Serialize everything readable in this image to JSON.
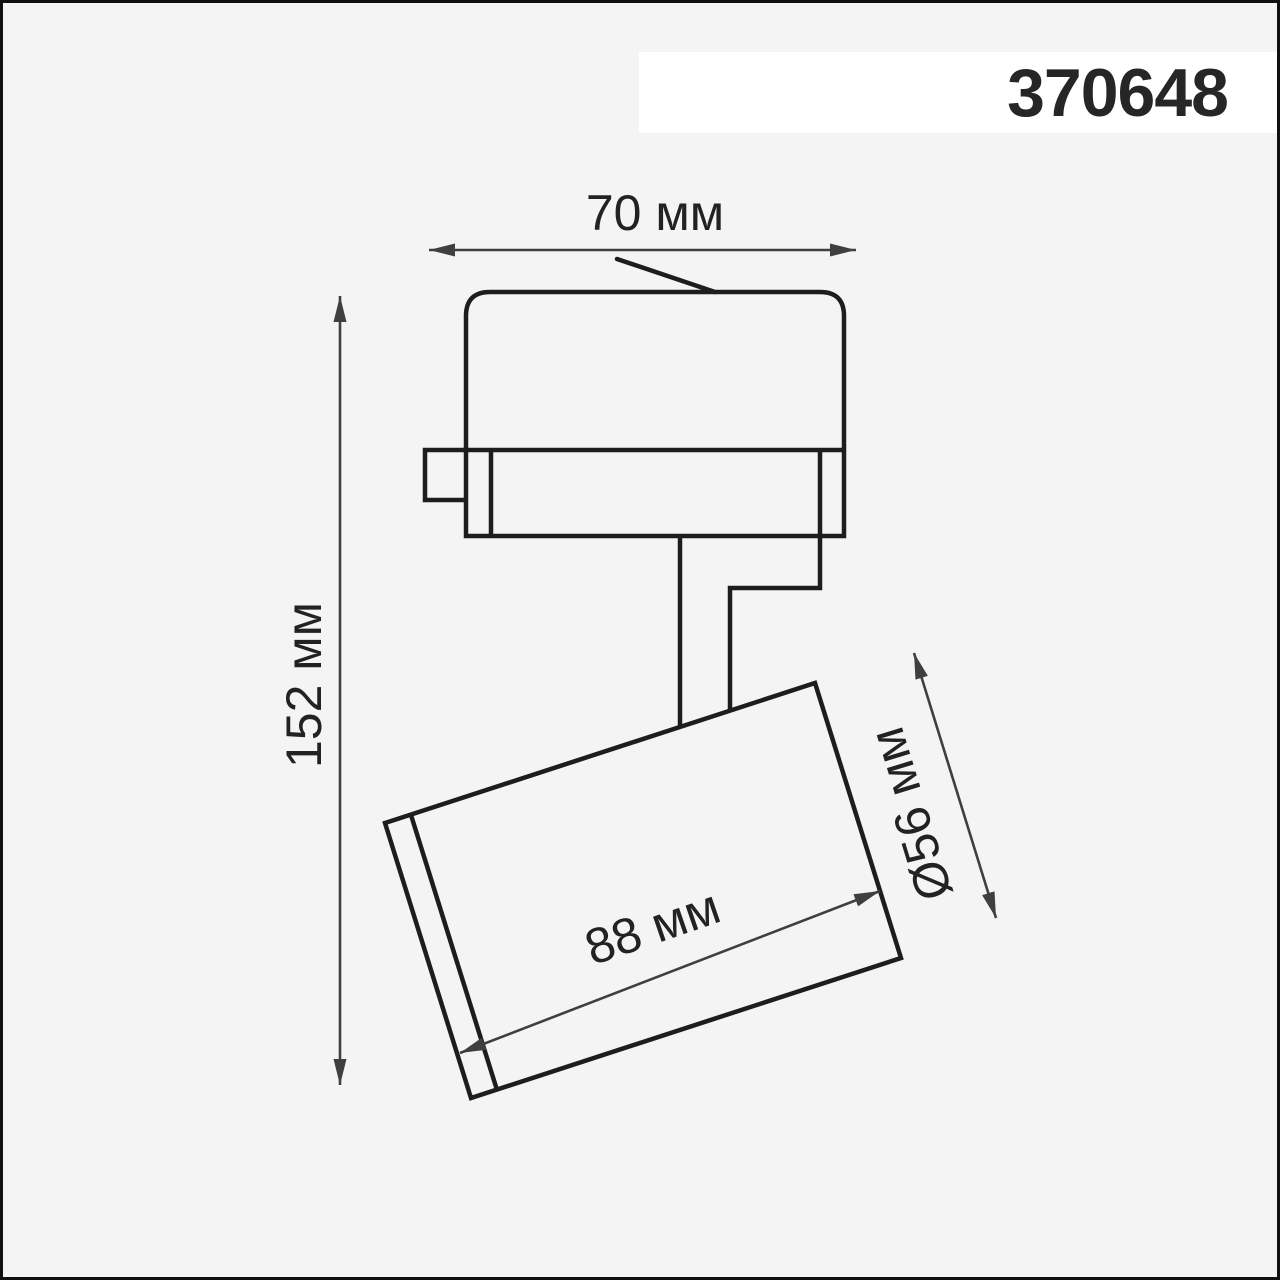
{
  "product": {
    "code": "370648"
  },
  "drawing": {
    "type": "track-spotlight dimension drawing",
    "dimensions": {
      "adapter_width": {
        "label": "70 мм",
        "value_mm": 70,
        "orientation": "horizontal-top"
      },
      "overall_height": {
        "label": "152 мм",
        "value_mm": 152,
        "orientation": "vertical-left"
      },
      "head_length": {
        "label": "88 мм",
        "value_mm": 88,
        "orientation": "along-head"
      },
      "head_diameter": {
        "label": "Ø56 мм",
        "value_mm": 56,
        "orientation": "across-head"
      }
    }
  },
  "colors": {
    "background": "#f4f4f4",
    "band": "#ffffff",
    "outline": "#1d1d1d",
    "dimension_lines": "#3f3f3f",
    "text": "#262626",
    "frame_border": "#101010"
  }
}
